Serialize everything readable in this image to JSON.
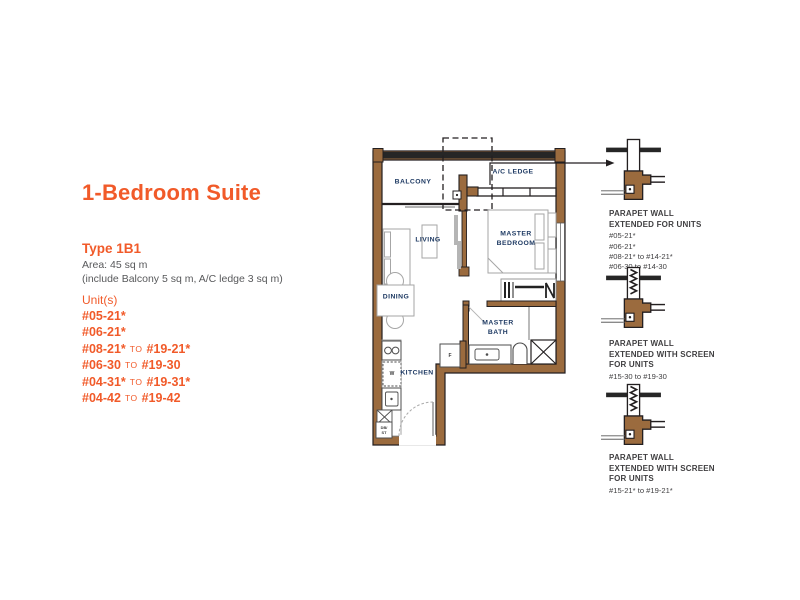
{
  "header": {
    "title": "1-Bedroom Suite"
  },
  "info": {
    "type": "Type 1B1",
    "area": "Area: 45 sq m",
    "area_note": "(include Balcony 5 sq m, A/C ledge 3 sq m)",
    "units_heading": "Unit(s)",
    "to_word": "TO",
    "units": [
      {
        "from": "#05-21*",
        "to": ""
      },
      {
        "from": "#06-21*",
        "to": ""
      },
      {
        "from": "#08-21*",
        "to": "#19-21*"
      },
      {
        "from": "#06-30",
        "to": "#19-30"
      },
      {
        "from": "#04-31*",
        "to": "#19-31*"
      },
      {
        "from": "#04-42",
        "to": "#19-42"
      }
    ]
  },
  "floorplan": {
    "labels": {
      "balcony": "BALCONY",
      "ac_ledge": "A/C LEDGE",
      "living": "LIVING",
      "master_bedroom_line1": "MASTER",
      "master_bedroom_line2": "BEDROOM",
      "dining": "DINING",
      "kitchen": "KITCHEN",
      "master_bath_line1": "MASTER",
      "master_bath_line2": "BATH",
      "fridge": "F",
      "washer": "W",
      "duct_line1": "DB/",
      "duct_line2": "ST"
    }
  },
  "details": [
    {
      "line1": "PARAPET WALL",
      "line2": "EXTENDED FOR UNITS",
      "units": [
        "#05-21*",
        "#06-21*",
        "#08-21* to #14-21*",
        "#06-30 to #14-30"
      ]
    },
    {
      "line1": "PARAPET WALL",
      "line2": "EXTENDED WITH SCREEN",
      "line3": "FOR UNITS",
      "units": [
        "#15-30 to #19-30"
      ]
    },
    {
      "line1": "PARAPET WALL",
      "line2": "EXTENDED WITH SCREEN",
      "line3": "FOR UNITS",
      "units": [
        "#15-21* to #19-21*"
      ]
    }
  ],
  "colors": {
    "accent_orange": "#F15A29",
    "room_label_navy": "#1E3A63",
    "body_gray": "#58595B",
    "wall_brown": "#9B6B3E",
    "outline_dark": "#231F20",
    "detail_text": "#414042"
  }
}
